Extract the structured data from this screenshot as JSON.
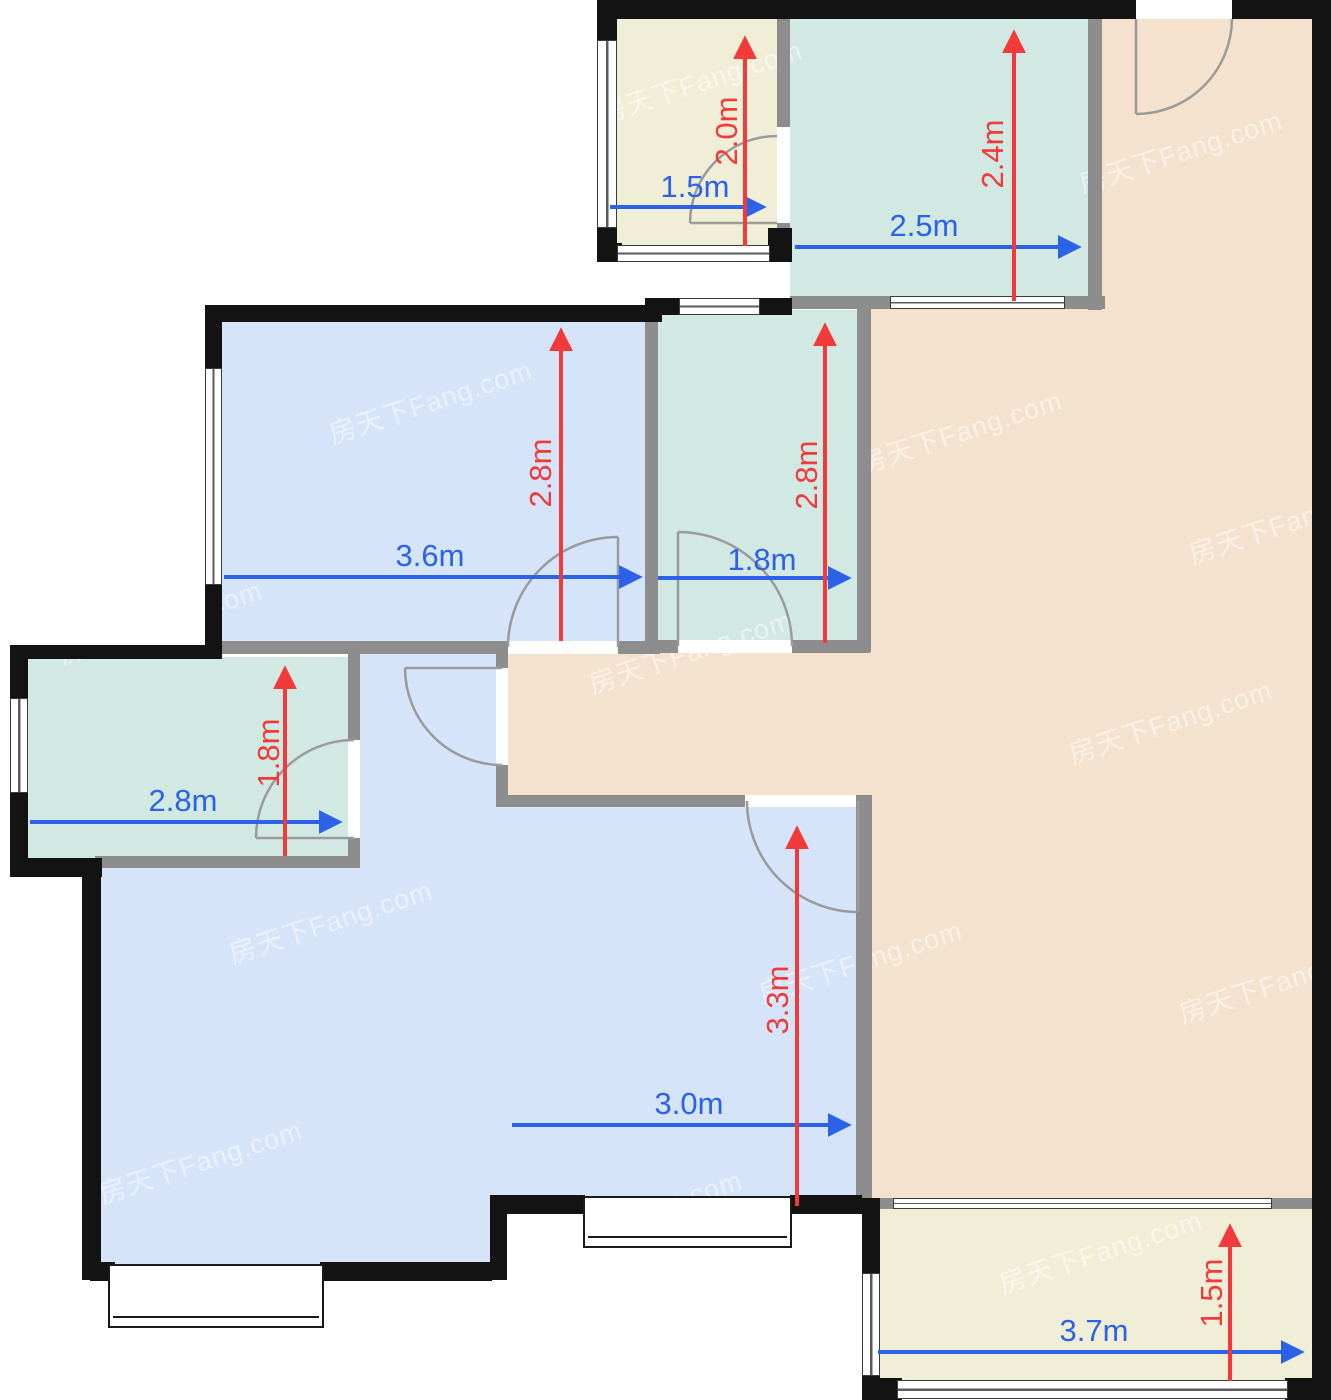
{
  "watermark": {
    "text": "房天下Fang.com"
  },
  "palette": {
    "wall_outer": "#131313",
    "wall_inner": "#8d8d8d",
    "dim_blue": "#2b62e8",
    "dim_red": "#f23a3a",
    "room_blue": "#d6e4fa",
    "room_teal": "#d2e8e2",
    "room_cream": "#f1eed8",
    "room_peach": "#f4e2ce",
    "door_arc": "#9a9a9a",
    "window_line": "#3a3a3a"
  },
  "rooms": [
    {
      "name": "top-left-small-room",
      "width_label": "1.5m",
      "depth_label": "2.0m",
      "color": "#f1eed8"
    },
    {
      "name": "top-kitchen-room",
      "width_label": "2.5m",
      "depth_label": "2.4m",
      "color": "#d2e8e2"
    },
    {
      "name": "bedroom-upper-left",
      "width_label": "3.6m",
      "depth_label": "2.8m",
      "color": "#d6e4fa"
    },
    {
      "name": "bathroom-middle",
      "width_label": "1.8m",
      "depth_label": "2.8m",
      "color": "#d2e8e2"
    },
    {
      "name": "small-room-left",
      "width_label": "2.8m",
      "depth_label": "1.8m",
      "color": "#d2e8e2"
    },
    {
      "name": "bedroom-lower-left",
      "color": "#d6e4fa"
    },
    {
      "name": "bedroom-bottom-middle",
      "width_label": "3.0m",
      "depth_label": "3.3m",
      "color": "#d6e4fa"
    },
    {
      "name": "living-dining-area",
      "color": "#f4e2ce"
    },
    {
      "name": "balcony",
      "width_label": "3.7m",
      "depth_label": "1.5m",
      "color": "#f1eed8"
    }
  ]
}
